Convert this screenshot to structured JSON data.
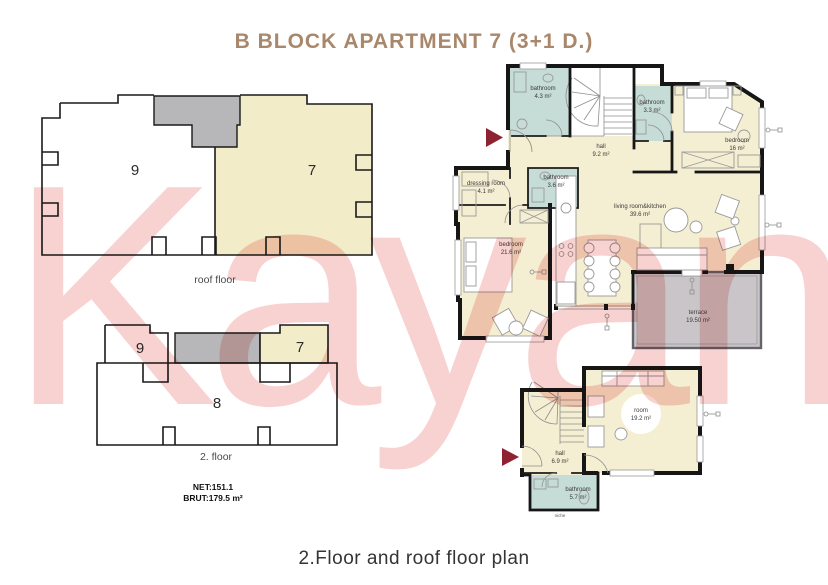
{
  "title": "B BLOCK APARTMENT 7 (3+1 D.)",
  "watermark": "Kayan",
  "footer_caption": "2.Floor and roof floor plan",
  "colors": {
    "title_text": "#a8876b",
    "wall": "#161616",
    "room_cream": "#f4eed2",
    "unit_cream": "#f3ecc8",
    "bathroom_teal": "#c6dcd6",
    "terrace_gray": "#c9c5c8",
    "block_gray": "#b7b6b8",
    "watermark_pink": "#f8d2d0",
    "arrow_red": "#8e2231"
  },
  "roof_plan": {
    "caption": "roof floor",
    "unit_left": "9",
    "unit_right": "7"
  },
  "second_plan": {
    "caption": "2. floor",
    "unit_left": "9",
    "unit_right": "7",
    "unit_bottom": "8"
  },
  "areas": {
    "net": "NET:151.1",
    "brut": "BRUT:179.5 m²"
  },
  "main_plan": {
    "bathroom1": {
      "name": "bathroom",
      "area": "4.3 m²"
    },
    "bathroom2": {
      "name": "bathroom",
      "area": "3.3 m²"
    },
    "bedroom1": {
      "name": "bedroom",
      "area": "16 m²"
    },
    "hall": {
      "name": "hall",
      "area": "9.2 m²"
    },
    "dressing": {
      "name": "dressing room",
      "area": "4.1 m²"
    },
    "bathroom3": {
      "name": "bathroom",
      "area": "3.6 m²"
    },
    "bedroom2": {
      "name": "bedroom",
      "area": "21.6 m²"
    },
    "living": {
      "name": "living room&kitchen",
      "area": "39.6 m²"
    },
    "terrace": {
      "name": "terrace",
      "area": "19.50 m²"
    }
  },
  "roof_detail": {
    "room": {
      "name": "room",
      "area": "19.2 m²"
    },
    "hall": {
      "name": "hall",
      "area": "6.9 m²"
    },
    "bathroom": {
      "name": "bathroom",
      "area": "5.7 m²"
    },
    "niche": "niche"
  }
}
